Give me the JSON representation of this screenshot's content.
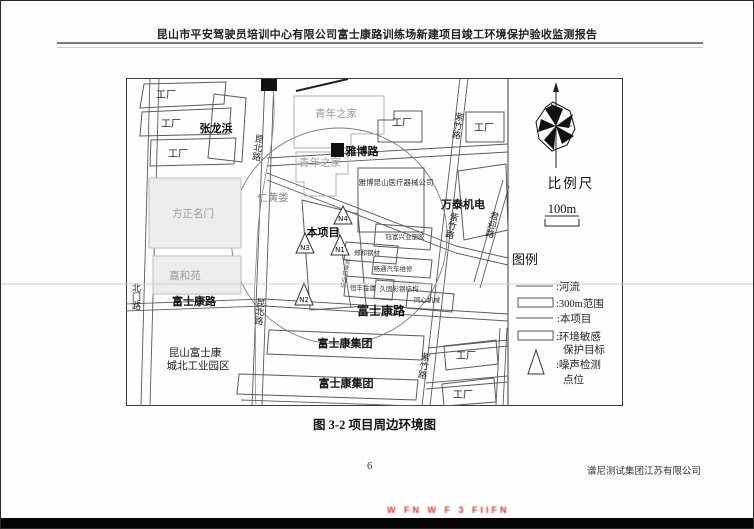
{
  "header": {
    "title": "昆山市平安驾驶员培训中心有限公司富士康路训练场新建项目竣工环境保护验收监测报告"
  },
  "figure": {
    "caption": "图 3-2  项目周边环境图",
    "scale_bar": {
      "title": "比例尺",
      "distance": "100m"
    },
    "legend": {
      "title": "图例",
      "river": ":河流",
      "range300m": ":300m范围",
      "project": ":本项目",
      "sensitive_line1": ":环境敏感",
      "sensitive_line2": "保护目标",
      "noise_line1": ":噪声检测",
      "noise_line2": "点位"
    },
    "map": {
      "roads": {
        "beimen_rd": "北门路",
        "kunbei_rd_top": "昆北路",
        "kunbei_rd_bottom": "昆北路",
        "yabo_rd": "雅博路",
        "fushikang_rd_left": "富士康路",
        "fushikang_rd_right": "富士康路",
        "zizhu_rd_top": "紫竹路",
        "zizhu_rd_mid": "紫竹路",
        "zizhu_rd_bottom": "紫竹路",
        "junying_rd": "君迎路"
      },
      "places": {
        "factory_nw1": "工厂",
        "factory_nw2": "工厂",
        "factory_nw3": "工厂",
        "zhanglongbang": "张龙浜",
        "youth_home_top": "青年之家",
        "factory_mid": "工厂",
        "factory_ne": "工厂",
        "youth_home_2": "青年之家",
        "medical_company": "雅博昆山医疗器械公司",
        "wantai_electric": "万泰机电",
        "renhuang_river": "仁黄娄",
        "fangzheng_mingmen": "方正名门",
        "project_site": "本项目",
        "yufu_plastics": "钰富兴业塑胶",
        "zhenghe_steel": "郑和钢材",
        "changtong_auto": "畅通汽车维修",
        "hengfeng_metal": "恒丰金属",
        "jiugu_steel": "久固彩钢结构",
        "tongxin_machinery": "同心机械",
        "training_ground": "驾驶培训场",
        "jiaheyuan": "嘉和苑",
        "foxconn_group_1": "富士康集团",
        "foxconn_park_line1": "昆山富士康",
        "foxconn_park_line2": "城北工业园区",
        "foxconn_group_2": "富士康集团",
        "factory_se1": "工厂",
        "factory_se2": "工厂"
      },
      "noise_points": {
        "n1": "N1",
        "n2": "N2",
        "n3": "N3",
        "n4": "N4"
      }
    }
  },
  "footer": {
    "page_number": "6",
    "company": "谱尼测试集团江苏有限公司"
  },
  "scan_artifacts": {
    "red_fragment": "W FN  W F 3  FIIFN"
  }
}
